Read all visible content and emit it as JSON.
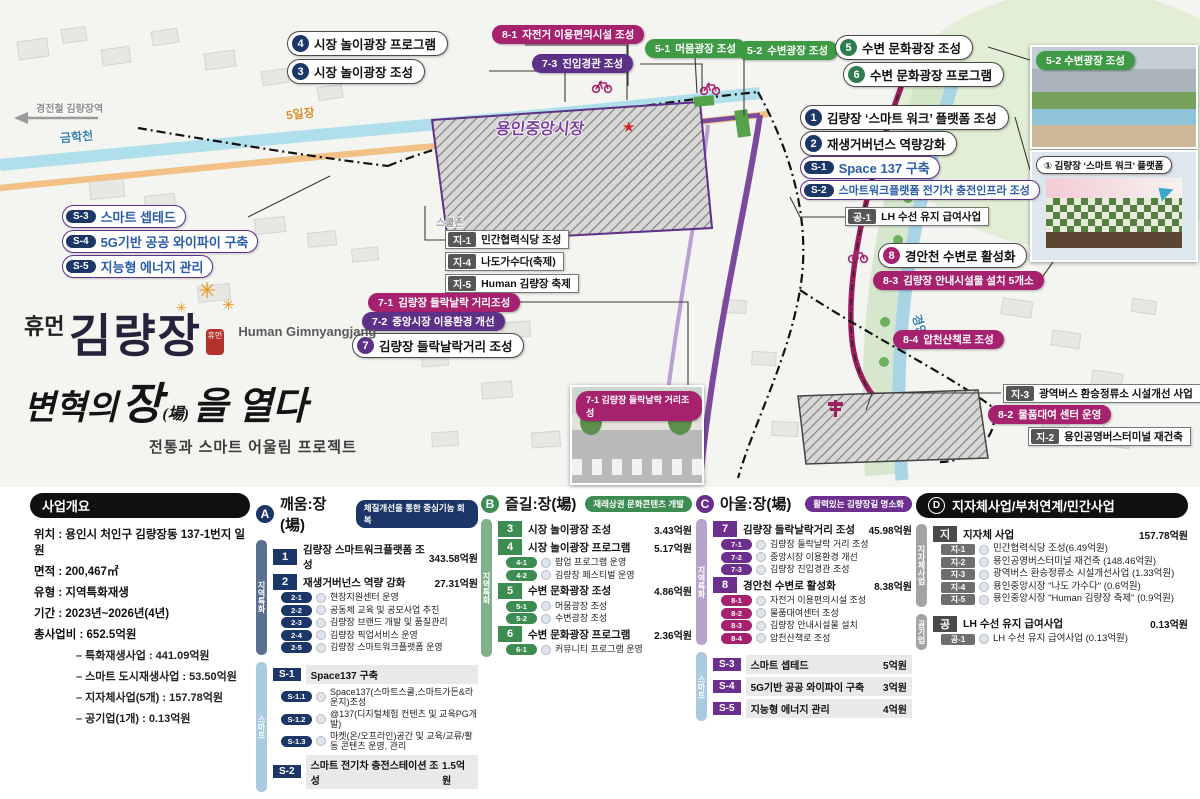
{
  "title_block": {
    "prefix": "휴먼",
    "name": "김량장",
    "seal": "휴먼",
    "romanized": "Human Gimnyangjang",
    "slogan_1": "변혁의",
    "slogan_2": "장",
    "slogan_2_hanja": "(場)",
    "slogan_3": "을 열다",
    "subtitle": "전통과 스마트 어울림 프로젝트"
  },
  "map": {
    "area_labels": {
      "stream_left": "금학천",
      "stream_right": "경안천",
      "market": "용인중앙시장",
      "five_day_market": "5일장",
      "school_zone": "스쿨존",
      "station_arrow": "경전철 김량장역"
    },
    "callouts": {
      "p4": {
        "badge": "4",
        "text": "시장 놀이광장 프로그램"
      },
      "p3": {
        "badge": "3",
        "text": "시장 놀이광장 조성"
      },
      "p81": {
        "badge": "8-1",
        "text": "자전거 이용편의시설 조성"
      },
      "p73": {
        "badge": "7-3",
        "text": "진입경관 조성"
      },
      "p51": {
        "badge": "5-1",
        "text": "머뭄광장 조성"
      },
      "p52": {
        "badge": "5-2",
        "text": "수변광장 조성"
      },
      "p5": {
        "badge": "5",
        "text": "수변 문화광장 조성"
      },
      "p6": {
        "badge": "6",
        "text": "수변 문화광장 프로그램"
      },
      "p1": {
        "badge": "1",
        "text": "김량장 ‘스마트 워크’ 플랫폼 조성"
      },
      "p2": {
        "badge": "2",
        "text": "재생거버넌스 역량강화"
      },
      "ps1": {
        "badge": "S-1",
        "text": "Space 137 구축"
      },
      "ps2": {
        "badge": "S-2",
        "text": "스마트워크플랫폼 전기차 충전인프라 조성"
      },
      "ps3": {
        "badge": "S-3",
        "text": "스마트 셉테드"
      },
      "ps4": {
        "badge": "S-4",
        "text": "5G기반 공공 와이파이 구축"
      },
      "ps5": {
        "badge": "S-5",
        "text": "지능형 에너지 관리"
      },
      "pg1": {
        "badge": "공-1",
        "text": "LH 수선 유지 급여사업"
      },
      "pj1": {
        "badge": "지-1",
        "text": "민간협력식당 조성"
      },
      "pj4": {
        "badge": "지-4",
        "text": "나도가수다(축제)"
      },
      "pj5": {
        "badge": "지-5",
        "text": "Human 김량장 축제"
      },
      "p8": {
        "badge": "8",
        "text": "경안천 수변로 활성화"
      },
      "p83": {
        "badge": "8-3",
        "text": "김량장 안내시설물 설치 5개소"
      },
      "p84": {
        "badge": "8-4",
        "text": "압천산책로 조성"
      },
      "p71": {
        "badge": "7-1",
        "text": "김량장 들락날락 거리조성"
      },
      "p72": {
        "badge": "7-2",
        "text": "중앙시장 이용환경 개선"
      },
      "p7": {
        "badge": "7",
        "text": "김량장 들락날락거리 조성"
      },
      "pj3": {
        "badge": "지-3",
        "text": "광역버스 환승정류소 시설개선 사업"
      },
      "p82": {
        "badge": "8-2",
        "text": "물품대여 센터 운영"
      },
      "pj2": {
        "badge": "지-2",
        "text": "용인공영버스터미널 재건축"
      }
    },
    "photos": {
      "riverside": {
        "badge": "5-2 수변광장 조성"
      },
      "platform": {
        "badge": "① 김량장 ‘스마트 워크’ 플랫폼"
      },
      "street": {
        "badge": "7-1 김량장 들락날락 거리조성"
      }
    }
  },
  "overview": {
    "header": "사업개요",
    "lines": [
      "위치 : 용인시 처인구 김량장동 137-1번지 일원",
      "면적 : 200,467㎡",
      "유형 : 지역특화재생",
      "기간 : 2023년~2026년(4년)",
      "총사업비 : 652.5억원"
    ],
    "sub_lines": [
      "– 특화재생사업 : 441.09억원",
      "– 스마트 도시재생사업 : 53.50억원",
      "– 지자체사업(5개) : 157.78억원",
      "– 공기업(1개) : 0.13억원"
    ]
  },
  "columns": {
    "col_a": {
      "letter": "A",
      "title": "깨움:장(場)",
      "tag": "체질개선을 통한 중심기능 회복",
      "color": "navy",
      "sections": [
        {
          "strip": "지역특화",
          "strip_style": "st-navy",
          "rows": [
            {
              "t": "item",
              "badge": "1",
              "title": "김량장 스마트워크플랫폼 조성",
              "amount": "343.58억원"
            },
            {
              "t": "item",
              "badge": "2",
              "title": "재생거버넌스 역량 강화",
              "amount": "27.31억원"
            },
            {
              "t": "sub",
              "badge": "2-1",
              "text": "현장지원센터 운영"
            },
            {
              "t": "sub",
              "badge": "2-2",
              "text": "공동체 교육 및 공모사업 추진"
            },
            {
              "t": "sub",
              "badge": "2-3",
              "text": "김량장 브랜드 개발 및 품질관리"
            },
            {
              "t": "sub",
              "badge": "2-4",
              "text": "김량장 픽업서비스 운영"
            },
            {
              "t": "sub",
              "badge": "2-5",
              "text": "김량장 스마트워크플랫폼 운영"
            }
          ]
        },
        {
          "strip": "스마트",
          "strip_style": "st-blue",
          "rows": [
            {
              "t": "shead",
              "badge": "S-1",
              "title": "Space137 구축"
            },
            {
              "t": "sub",
              "badge": "S-1.1",
              "text": "Space137(스마트스쿨,스마트가든&라운지)조성"
            },
            {
              "t": "sub",
              "badge": "S-1.2",
              "text": "@137(디지털체험 컨텐츠 및 교육PG개발)"
            },
            {
              "t": "sub",
              "badge": "S-1.3",
              "text": "마켓(온/오프라인)공간 및 교육/교류/활동 콘텐츠 운영, 관리"
            },
            {
              "t": "shead",
              "badge": "S-2",
              "title": "스마트 전기차 충전스테이션 조성",
              "amount": "1.5억원"
            }
          ]
        }
      ]
    },
    "col_b": {
      "letter": "B",
      "title": "즐길:장(場)",
      "tag": "재래상권 문화콘텐츠 개발",
      "color": "green",
      "sections": [
        {
          "strip": "지역특화",
          "strip_style": "st-green",
          "rows": [
            {
              "t": "item",
              "badge": "3",
              "title": "시장 놀이광장 조성",
              "amount": "3.43억원"
            },
            {
              "t": "item",
              "badge": "4",
              "title": "시장 놀이광장 프로그램",
              "amount": "5.17억원"
            },
            {
              "t": "sub",
              "badge": "4-1",
              "text": "팝업 프로그램 운영"
            },
            {
              "t": "sub",
              "badge": "4-2",
              "text": "김량장 페스티벌 운영"
            },
            {
              "t": "item",
              "badge": "5",
              "title": "수변 문화광장 조성",
              "amount": "4.86억원"
            },
            {
              "t": "sub",
              "badge": "5-1",
              "text": "머뭄광장 조성"
            },
            {
              "t": "sub",
              "badge": "5-2",
              "text": "수변광장 조성"
            },
            {
              "t": "item",
              "badge": "6",
              "title": "수변 문화광장 프로그램",
              "amount": "2.36억원"
            },
            {
              "t": "sub",
              "badge": "6-1",
              "text": "커뮤니티 프로그램 운영"
            }
          ]
        }
      ]
    },
    "col_c": {
      "letter": "C",
      "title": "아울:장(場)",
      "tag": "활력있는 김량장길 명소화",
      "color": "purple",
      "sections": [
        {
          "strip": "지역특화",
          "strip_style": "st-lpurple",
          "rows": [
            {
              "t": "item",
              "badge": "7",
              "title": "김량장 들락날락거리 조성",
              "amount": "45.98억원"
            },
            {
              "t": "sub",
              "badge": "7-1",
              "text": "김량장 들락날락 거리 조성"
            },
            {
              "t": "sub",
              "badge": "7-2",
              "text": "중앙시장 이용환경 개선"
            },
            {
              "t": "sub",
              "badge": "7-3",
              "text": "김량장 진입경관 조성"
            },
            {
              "t": "item",
              "badge": "8",
              "title": "경안천 수변로 활성화",
              "amount": "8.38억원"
            },
            {
              "t": "sub",
              "badge": "8-1",
              "text": "자전거 이용편의시설 조성",
              "bs": "bg-magenta"
            },
            {
              "t": "sub",
              "badge": "8-2",
              "text": "물품대여센터 조성",
              "bs": "bg-magenta"
            },
            {
              "t": "sub",
              "badge": "8-3",
              "text": "김량장 안내시설물 설치",
              "bs": "bg-magenta"
            },
            {
              "t": "sub",
              "badge": "8-4",
              "text": "압천산책로 조성",
              "bs": "bg-magenta"
            }
          ]
        },
        {
          "strip": "스마트",
          "strip_style": "st-blue",
          "rows": [
            {
              "t": "shead",
              "badge": "S-3",
              "title": "스마트 셉테드",
              "amount": "5억원"
            },
            {
              "t": "shead",
              "badge": "S-4",
              "title": "5G기반 공공 와이파이 구축",
              "amount": "3억원"
            },
            {
              "t": "shead",
              "badge": "S-5",
              "title": "지능형 에너지 관리",
              "amount": "4억원"
            }
          ]
        }
      ]
    },
    "col_d": {
      "letter": "D",
      "title": "지자체사업/부처연계/민간사업",
      "color": "dark",
      "sections": [
        {
          "strip": "지자체사업",
          "strip_style": "st-gray",
          "rows": [
            {
              "t": "item",
              "badge": "지",
              "title": "지자체 사업",
              "amount": "157.78억원"
            },
            {
              "t": "sub",
              "badge": "지-1",
              "text": "민간협력식당 조성(6.49억원)"
            },
            {
              "t": "sub",
              "badge": "지-2",
              "text": "용인공영버스터미널 재건축 (148.46억원)"
            },
            {
              "t": "sub",
              "badge": "지-3",
              "text": "광역버스 환승정류소 시설개선사업 (1.33억원)"
            },
            {
              "t": "sub",
              "badge": "지-4",
              "text": "용인중앙시장 \"나도 가수다\" (0.6억원)"
            },
            {
              "t": "sub",
              "badge": "지-5",
              "text": "용인중앙시장 \"Human 김량장 축제\" (0.9억원)"
            }
          ]
        },
        {
          "strip": "공기업",
          "strip_style": "st-gray",
          "rows": [
            {
              "t": "item",
              "badge": "공",
              "title": "LH 수선 유지 급여사업",
              "amount": "0.13억원"
            },
            {
              "t": "sub",
              "badge": "공-1",
              "text": "LH 수선 유지 급여사업 (0.13억원)"
            }
          ]
        }
      ]
    }
  }
}
